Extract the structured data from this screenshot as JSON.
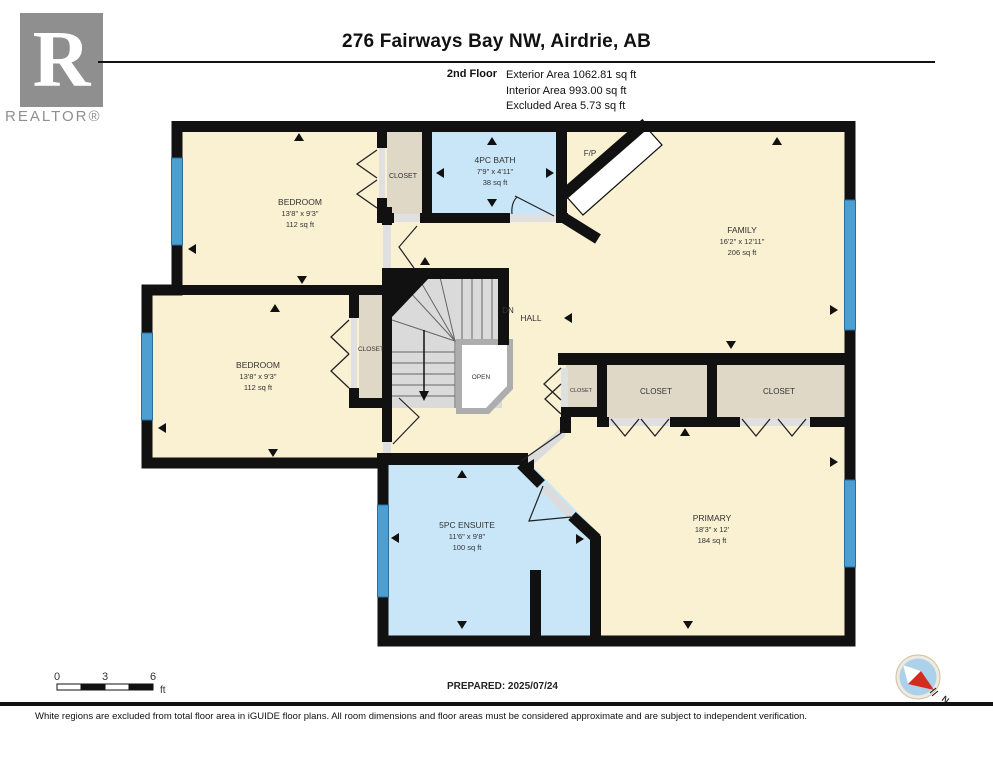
{
  "header": {
    "title": "276 Fairways Bay NW, Airdrie, AB",
    "floor_label": "2nd Floor",
    "exterior": "Exterior Area 1062.81 sq ft",
    "interior": "Interior Area 993.00 sq ft",
    "excluded": "Excluded Area 5.73 sq ft"
  },
  "logo": {
    "letter": "R",
    "brand": "REALTOR®"
  },
  "rooms": {
    "bedroom1": {
      "name": "BEDROOM",
      "dims": "13'8\" x 9'3\"",
      "area": "112 sq ft"
    },
    "bedroom2": {
      "name": "BEDROOM",
      "dims": "13'8\" x 9'3\"",
      "area": "112 sq ft"
    },
    "bath": {
      "name": "4PC BATH",
      "dims": "7'9\" x 4'11\"",
      "area": "38 sq ft"
    },
    "family": {
      "name": "FAMILY",
      "dims": "16'2\" x 12'11\"",
      "area": "206 sq ft"
    },
    "ensuite": {
      "name": "5PC ENSUITE",
      "dims": "11'6\" x 9'8\"",
      "area": "100 sq ft"
    },
    "primary": {
      "name": "PRIMARY",
      "dims": "18'3\" x 12'",
      "area": "184 sq ft"
    }
  },
  "labels": {
    "closet": "CLOSET",
    "open": "OPEN",
    "dn": "DN",
    "hall": "HALL",
    "fp": "F/P",
    "north": "N"
  },
  "scale": {
    "t0": "0",
    "t3": "3",
    "t6": "6",
    "unit": "ft"
  },
  "footer": {
    "prepared": "PREPARED: 2025/07/24",
    "disclaimer": "White regions are excluded from total floor area in iGUIDE floor plans. All room dimensions and floor areas must be considered approximate and are subject to independent verification."
  },
  "colors": {
    "floor": "#FAF0D2",
    "wet": "#C9E6F8",
    "closet_fill": "#E0D8C7",
    "window": "#4E9FD1",
    "wall": "#111111",
    "stairs": "#DADADA",
    "compass_blue": "#ABD2EA",
    "compass_red": "#D42B1E"
  }
}
